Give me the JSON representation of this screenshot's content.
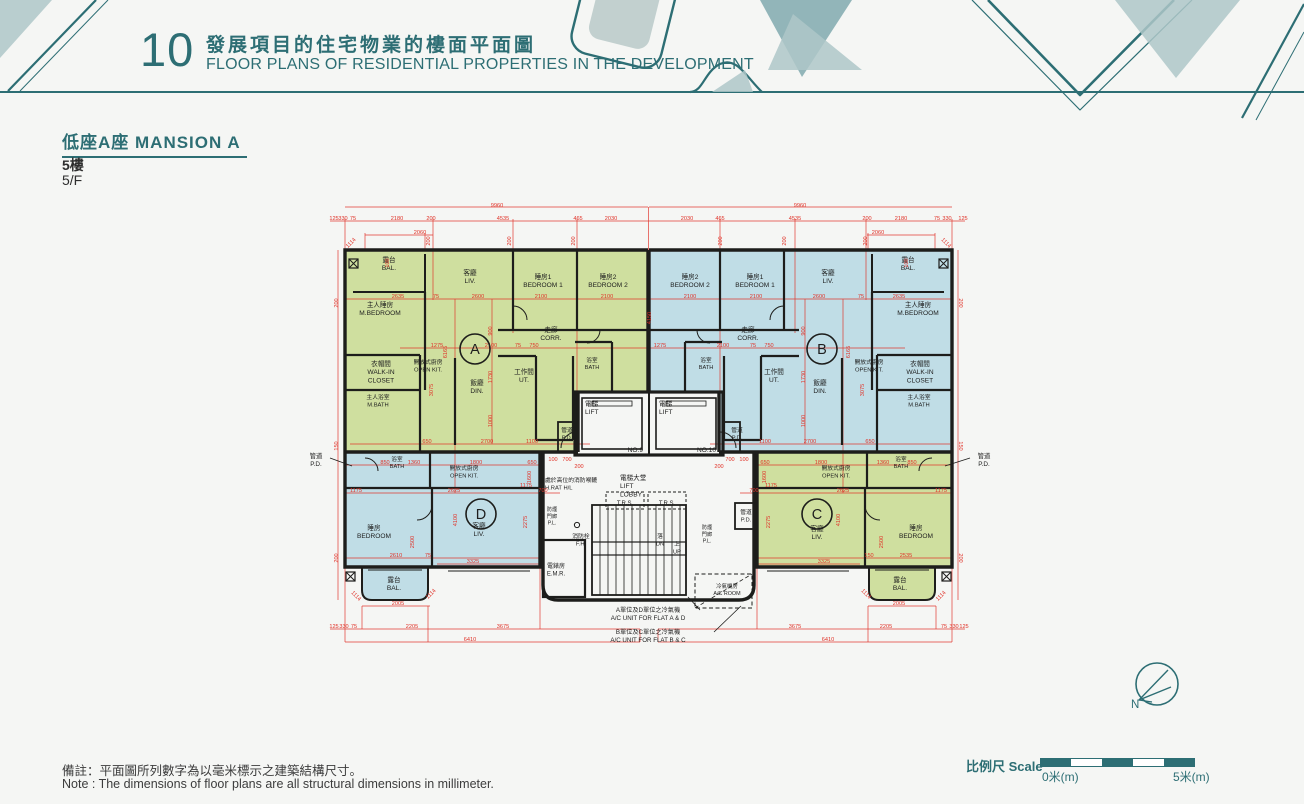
{
  "colors": {
    "teal": "#2d6e74",
    "red": "#e03228",
    "green": "#cfdf9f",
    "blue": "#c0dde6",
    "wall": "#1d1d1b"
  },
  "header": {
    "number": "10",
    "title_zh": "發展項目的住宅物業的樓面平面圖",
    "title_en": "FLOOR PLANS OF RESIDENTIAL PROPERTIES IN THE DEVELOPMENT"
  },
  "section": {
    "title": "低座A座 MANSION A",
    "floor_zh": "5樓",
    "floor_en": "5/F"
  },
  "notes": {
    "zh": "備註：平面圖所列數字為以毫米標示之建築結構尺寸。",
    "en": "Note : The dimensions of floor plans are all structural dimensions in millimeter."
  },
  "scalebar": {
    "label": "比例尺 Scale",
    "start": "0米(m)",
    "end": "5米(m)"
  },
  "compass": {
    "label": "N"
  },
  "floorplan": {
    "unit_marks": [
      {
        "id": "A",
        "x": 475,
        "y": 349
      },
      {
        "id": "B",
        "x": 822,
        "y": 349
      },
      {
        "id": "C",
        "x": 817,
        "y": 514
      },
      {
        "id": "D",
        "x": 481,
        "y": 514
      }
    ],
    "room_labels": [
      {
        "x": 389,
        "y": 262,
        "l": [
          "露台",
          "BAL."
        ]
      },
      {
        "x": 470,
        "y": 275,
        "l": [
          "客廳",
          "LIV."
        ]
      },
      {
        "x": 543,
        "y": 279,
        "l": [
          "睡房1",
          "BEDROOM 1"
        ]
      },
      {
        "x": 608,
        "y": 279,
        "l": [
          "睡房2",
          "BEDROOM 2"
        ]
      },
      {
        "x": 380,
        "y": 307,
        "l": [
          "主人睡房",
          "M.BEDROOM"
        ]
      },
      {
        "x": 551,
        "y": 332,
        "l": [
          "走廊",
          "CORR."
        ]
      },
      {
        "x": 381,
        "y": 366,
        "l": [
          "衣帽間",
          "WALK-IN",
          "CLOSET"
        ]
      },
      {
        "x": 428,
        "y": 364,
        "l": [
          "開放式廚房",
          "OPEN KIT."
        ],
        "s": 5.8
      },
      {
        "x": 592,
        "y": 362,
        "l": [
          "浴室",
          "BATH"
        ],
        "s": 5.6
      },
      {
        "x": 524,
        "y": 374,
        "l": [
          "工作間",
          "UT."
        ]
      },
      {
        "x": 477,
        "y": 385,
        "l": [
          "飯廳",
          "DIN."
        ]
      },
      {
        "x": 378,
        "y": 399,
        "l": [
          "主人浴室",
          "M.BATH"
        ],
        "s": 5.8
      },
      {
        "x": 908,
        "y": 262,
        "l": [
          "露台",
          "BAL."
        ]
      },
      {
        "x": 828,
        "y": 275,
        "l": [
          "客廳",
          "LIV."
        ]
      },
      {
        "x": 755,
        "y": 279,
        "l": [
          "睡房1",
          "BEDROOM 1"
        ]
      },
      {
        "x": 690,
        "y": 279,
        "l": [
          "睡房2",
          "BEDROOM 2"
        ]
      },
      {
        "x": 918,
        "y": 307,
        "l": [
          "主人睡房",
          "M.BEDROOM"
        ]
      },
      {
        "x": 748,
        "y": 332,
        "l": [
          "走廊",
          "CORR."
        ]
      },
      {
        "x": 920,
        "y": 366,
        "l": [
          "衣帽間",
          "WALK-IN",
          "CLOSET"
        ]
      },
      {
        "x": 869,
        "y": 364,
        "l": [
          "開放式廚房",
          "OPEN KIT."
        ],
        "s": 5.8
      },
      {
        "x": 706,
        "y": 362,
        "l": [
          "浴室",
          "BATH"
        ],
        "s": 5.6
      },
      {
        "x": 774,
        "y": 374,
        "l": [
          "工作間",
          "UT."
        ]
      },
      {
        "x": 820,
        "y": 385,
        "l": [
          "飯廳",
          "DIN."
        ]
      },
      {
        "x": 919,
        "y": 399,
        "l": [
          "主人浴室",
          "M.BATH"
        ],
        "s": 5.8
      },
      {
        "x": 397,
        "y": 461,
        "l": [
          "浴室",
          "BATH"
        ],
        "s": 5.6
      },
      {
        "x": 464,
        "y": 470,
        "l": [
          "開放式廚房",
          "OPEN KIT."
        ],
        "s": 5.8
      },
      {
        "x": 374,
        "y": 530,
        "l": [
          "睡房",
          "BEDROOM"
        ]
      },
      {
        "x": 479,
        "y": 528,
        "l": [
          "客廳",
          "LIV."
        ]
      },
      {
        "x": 394,
        "y": 582,
        "l": [
          "露台",
          "BAL."
        ]
      },
      {
        "x": 901,
        "y": 461,
        "l": [
          "浴室",
          "BATH"
        ],
        "s": 5.6
      },
      {
        "x": 836,
        "y": 470,
        "l": [
          "開放式廚房",
          "OPEN KIT."
        ],
        "s": 5.8
      },
      {
        "x": 916,
        "y": 530,
        "l": [
          "睡房",
          "BEDROOM"
        ]
      },
      {
        "x": 817,
        "y": 531,
        "l": [
          "客廳",
          "LIV."
        ]
      },
      {
        "x": 900,
        "y": 582,
        "l": [
          "露台",
          "BAL."
        ]
      },
      {
        "x": 585,
        "y": 406,
        "l": [
          "電梯",
          "LIFT"
        ],
        "a": "start"
      },
      {
        "x": 659,
        "y": 406,
        "l": [
          "電梯",
          "LIFT"
        ],
        "a": "start"
      },
      {
        "x": 643,
        "y": 452,
        "l": [
          "NO.9"
        ],
        "a": "end"
      },
      {
        "x": 716,
        "y": 452,
        "l": [
          "NO.10"
        ],
        "a": "end"
      },
      {
        "x": 620,
        "y": 480,
        "l": [
          "電梯大堂",
          "LIFT",
          "LOBBY"
        ],
        "a": "start"
      },
      {
        "x": 545,
        "y": 482,
        "l": [
          "處於高位的消防喉轆",
          "H.RAT H/L"
        ],
        "a": "start",
        "s": 5.8
      },
      {
        "x": 625,
        "y": 505,
        "l": [
          "T.R.S."
        ],
        "s": 6
      },
      {
        "x": 667,
        "y": 505,
        "l": [
          "T.R.S."
        ],
        "s": 6
      },
      {
        "x": 581,
        "y": 538,
        "l": [
          "消防栓",
          "F.H."
        ],
        "s": 5.8
      },
      {
        "x": 660,
        "y": 538,
        "l": [
          "落",
          "DN"
        ],
        "s": 5.8
      },
      {
        "x": 677,
        "y": 546,
        "l": [
          "上",
          "UP"
        ],
        "s": 5.8
      },
      {
        "x": 556,
        "y": 568,
        "l": [
          "電錶房",
          "E.M.R."
        ],
        "s": 6
      },
      {
        "x": 552,
        "y": 511,
        "l": [
          "防煙",
          "門廊",
          "P.L."
        ],
        "s": 5.2
      },
      {
        "x": 707,
        "y": 529,
        "l": [
          "防煙",
          "門廊",
          "P.L."
        ],
        "s": 5.2
      },
      {
        "x": 746,
        "y": 514,
        "l": [
          "管道",
          "P.D."
        ],
        "s": 5.8
      },
      {
        "x": 567,
        "y": 432,
        "l": [
          "管道",
          "P.D."
        ],
        "s": 5.8
      },
      {
        "x": 737,
        "y": 432,
        "l": [
          "管道",
          "P.D."
        ],
        "s": 5.8
      },
      {
        "x": 316,
        "y": 458,
        "l": [
          "管道",
          "P.D."
        ],
        "s": 6.4
      },
      {
        "x": 984,
        "y": 458,
        "l": [
          "管道",
          "P.D."
        ],
        "s": 6.4
      },
      {
        "x": 727,
        "y": 588,
        "l": [
          "冷氣機房",
          "A/C ROOM"
        ],
        "s": 5.4
      },
      {
        "x": 648,
        "y": 612,
        "l": [
          "A單位及D單位之冷氣機",
          "A/C UNIT FOR FLAT A & D"
        ],
        "s": 6.2
      },
      {
        "x": 648,
        "y": 634,
        "l": [
          "B單位及C單位之冷氣機",
          "A/C UNIT FOR FLAT B & C"
        ],
        "s": 6.2
      }
    ],
    "dims": [
      [
        497,
        207,
        "9960"
      ],
      [
        800,
        207,
        "9960"
      ],
      [
        334,
        220,
        "125"
      ],
      [
        343,
        220,
        "330"
      ],
      [
        353,
        220,
        "75"
      ],
      [
        397,
        220,
        "2180"
      ],
      [
        431,
        220,
        "200"
      ],
      [
        503,
        220,
        "4535"
      ],
      [
        578,
        220,
        "465"
      ],
      [
        611,
        220,
        "2030"
      ],
      [
        687,
        220,
        "2030"
      ],
      [
        720,
        220,
        "465"
      ],
      [
        795,
        220,
        "4535"
      ],
      [
        867,
        220,
        "200"
      ],
      [
        901,
        220,
        "2180"
      ],
      [
        937,
        220,
        "75"
      ],
      [
        947,
        220,
        "330"
      ],
      [
        963,
        220,
        "125"
      ],
      [
        420,
        234,
        "2060"
      ],
      [
        878,
        234,
        "2060"
      ],
      [
        352,
        244,
        "1114",
        -45
      ],
      [
        945,
        244,
        "1114",
        45
      ],
      [
        338,
        303,
        "200",
        -90
      ],
      [
        338,
        446,
        "150",
        -90
      ],
      [
        338,
        558,
        "200",
        -90
      ],
      [
        959,
        303,
        "200",
        90
      ],
      [
        959,
        446,
        "150",
        90
      ],
      [
        959,
        558,
        "200",
        90
      ],
      [
        430,
        241,
        "200",
        -90
      ],
      [
        511,
        241,
        "200",
        -90
      ],
      [
        575,
        241,
        "200",
        -90
      ],
      [
        722,
        241,
        "200",
        -90
      ],
      [
        786,
        241,
        "200",
        -90
      ],
      [
        867,
        241,
        "200",
        -90
      ],
      [
        389,
        263,
        "100",
        -90
      ],
      [
        908,
        263,
        "100",
        -90
      ],
      [
        398,
        298,
        "2635"
      ],
      [
        436,
        298,
        "75"
      ],
      [
        478,
        298,
        "2600"
      ],
      [
        541,
        298,
        "2100"
      ],
      [
        607,
        298,
        "2100"
      ],
      [
        690,
        298,
        "2100"
      ],
      [
        756,
        298,
        "2100"
      ],
      [
        819,
        298,
        "2600"
      ],
      [
        861,
        298,
        "75"
      ],
      [
        899,
        298,
        "2635"
      ],
      [
        437,
        347,
        "1275"
      ],
      [
        491,
        347,
        "2100"
      ],
      [
        518,
        347,
        "75"
      ],
      [
        534,
        347,
        "750"
      ],
      [
        660,
        347,
        "1275"
      ],
      [
        723,
        347,
        "2100"
      ],
      [
        753,
        347,
        "75"
      ],
      [
        769,
        347,
        "750"
      ],
      [
        447,
        352,
        "6165",
        -90
      ],
      [
        850,
        352,
        "6165",
        -90
      ],
      [
        651,
        318,
        "4150",
        -90
      ],
      [
        492,
        331,
        "900",
        -90
      ],
      [
        492,
        377,
        "1730",
        -90
      ],
      [
        492,
        421,
        "1000",
        -90
      ],
      [
        805,
        331,
        "900",
        -90
      ],
      [
        805,
        377,
        "1730",
        -90
      ],
      [
        805,
        421,
        "1000",
        -90
      ],
      [
        433,
        390,
        "3075",
        -90
      ],
      [
        864,
        390,
        "3075",
        -90
      ],
      [
        427,
        443,
        "650"
      ],
      [
        487,
        443,
        "2700"
      ],
      [
        532,
        443,
        "1100"
      ],
      [
        765,
        443,
        "1100"
      ],
      [
        810,
        443,
        "2700"
      ],
      [
        870,
        443,
        "650"
      ],
      [
        553,
        461,
        "100"
      ],
      [
        567,
        461,
        "700"
      ],
      [
        730,
        461,
        "700"
      ],
      [
        744,
        461,
        "100"
      ],
      [
        579,
        468,
        "200"
      ],
      [
        719,
        468,
        "200"
      ],
      [
        385,
        464,
        "850"
      ],
      [
        414,
        464,
        "1360"
      ],
      [
        476,
        464,
        "1800"
      ],
      [
        532,
        464,
        "650"
      ],
      [
        765,
        464,
        "650"
      ],
      [
        821,
        464,
        "1800"
      ],
      [
        883,
        464,
        "1360"
      ],
      [
        912,
        464,
        "850"
      ],
      [
        356,
        492,
        "1175"
      ],
      [
        454,
        492,
        "2625"
      ],
      [
        526,
        487,
        "1175"
      ],
      [
        543,
        492,
        "700"
      ],
      [
        754,
        492,
        "700"
      ],
      [
        771,
        487,
        "1175"
      ],
      [
        843,
        492,
        "2625"
      ],
      [
        941,
        492,
        "1175"
      ],
      [
        531,
        477,
        "1600",
        -90
      ],
      [
        766,
        477,
        "1600",
        -90
      ],
      [
        396,
        557,
        "2610"
      ],
      [
        428,
        557,
        "75"
      ],
      [
        473,
        563,
        "3325"
      ],
      [
        824,
        563,
        "3325"
      ],
      [
        869,
        557,
        "150"
      ],
      [
        906,
        557,
        "2535"
      ],
      [
        457,
        520,
        "4100",
        -90
      ],
      [
        527,
        522,
        "2275",
        -90
      ],
      [
        414,
        542,
        "2500",
        -90
      ],
      [
        840,
        520,
        "4100",
        -90
      ],
      [
        770,
        522,
        "2275",
        -90
      ],
      [
        883,
        542,
        "2500",
        -90
      ],
      [
        398,
        605,
        "2005"
      ],
      [
        899,
        605,
        "2005"
      ],
      [
        355,
        597,
        "1114",
        45
      ],
      [
        432,
        595,
        "1114",
        -45
      ],
      [
        865,
        595,
        "1114",
        45
      ],
      [
        942,
        597,
        "1114",
        -45
      ],
      [
        334,
        628,
        "125"
      ],
      [
        344,
        628,
        "330"
      ],
      [
        354,
        628,
        "75"
      ],
      [
        412,
        628,
        "2205"
      ],
      [
        503,
        628,
        "3675"
      ],
      [
        795,
        628,
        "3675"
      ],
      [
        886,
        628,
        "2205"
      ],
      [
        944,
        628,
        "75"
      ],
      [
        954,
        628,
        "330"
      ],
      [
        964,
        628,
        "125"
      ],
      [
        470,
        641,
        "6410"
      ],
      [
        828,
        641,
        "6410"
      ]
    ]
  }
}
